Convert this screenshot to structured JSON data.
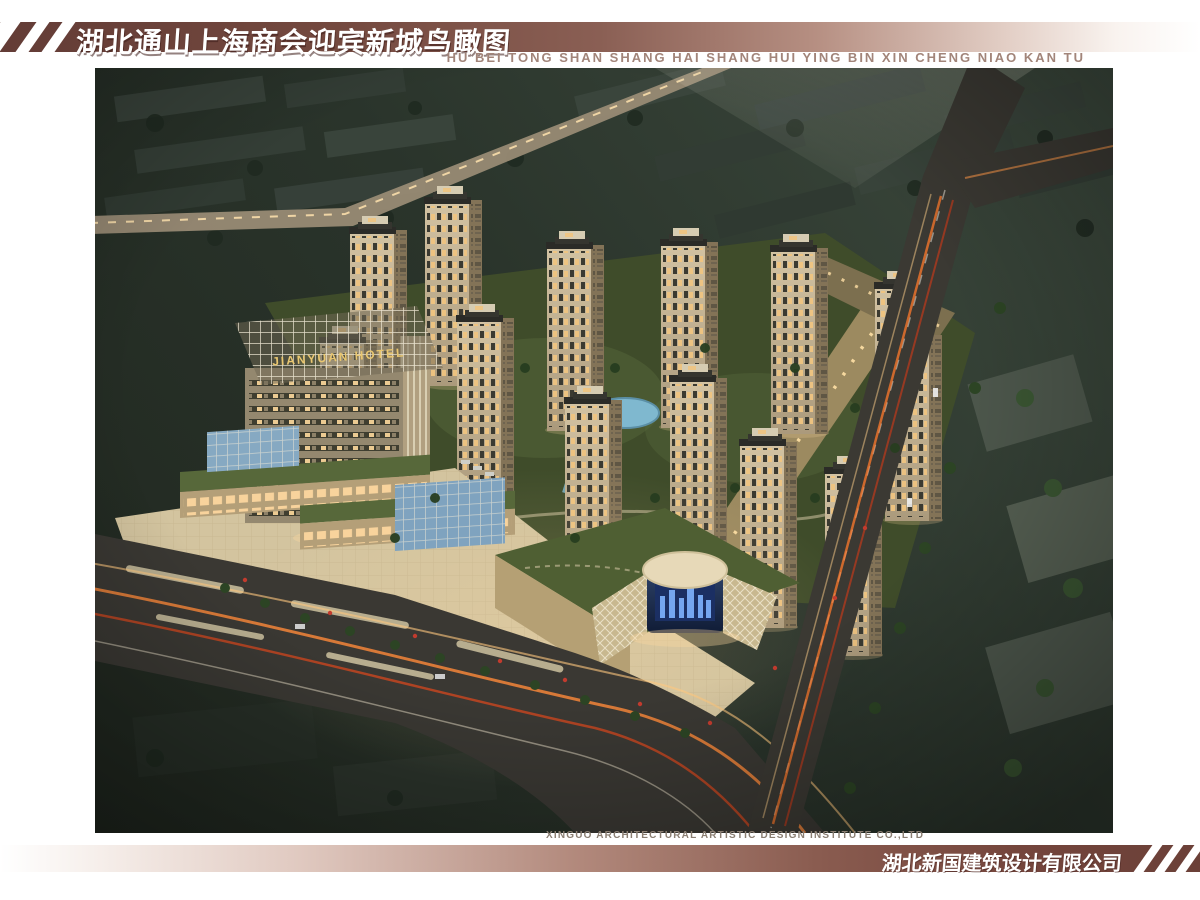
{
  "header": {
    "title_cn": "湖北通山上海商会迎宾新城鸟瞰图",
    "subtitle_pinyin": "HU BEI TONG SHAN SHANG HAI SHANG HUI YING BIN XIN CHENG NIAO KAN TU"
  },
  "rendering": {
    "description": "Night-time aerial bird's-eye rendering of Yingbin New Town: hotel tower, residential high-rises, commercial center with round glass atrium, roads with light trails",
    "hotel_sign": "JIANYUAN HOTEL"
  },
  "footer": {
    "credit_en": "XINGUO ARCHITECTURAL ARTISTIC DESIGN INSTITUTE CO.,LTD",
    "company_cn": "湖北新国建筑设计有限公司"
  },
  "colors": {
    "accent_maroon": "#74453c",
    "pinyin_text": "#a2857a",
    "credit_text": "#8a7e72",
    "scene_background": "#2a342b",
    "tower_facade": "#c9b898",
    "lit_window": "#efc480",
    "lawn": "#46522e",
    "plaza_pavement": "#d3c49f",
    "road_asphalt": "#3a3833",
    "light_trail_orange": "#ff8a3a",
    "pond_water": "#7fb8cf",
    "hotel_sign_gold": "#e9c771"
  }
}
